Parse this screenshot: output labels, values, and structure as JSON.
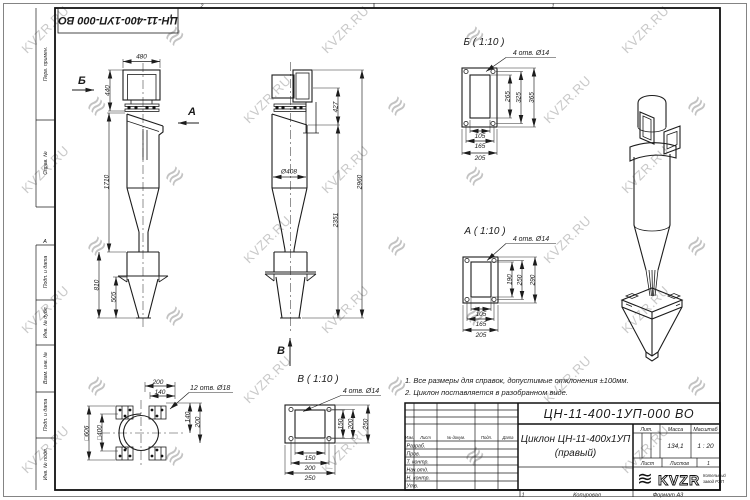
{
  "sheet": {
    "zone_top_left": "2",
    "zone_top_right": "1",
    "zone_left": "А",
    "stamp_top": "ЦН-11-400-1УП-000 ВО"
  },
  "margin_labels": {
    "perv": "Перв. примен.",
    "sprav": "Справ. №",
    "podp1": "Подп. и дата",
    "inv_dubl": "Инв. № дубл.",
    "vzam": "Взам. инв. №",
    "podp2": "Подп. и дата",
    "inv_podl": "Инв. № подл."
  },
  "views": {
    "side": {
      "arrow_b": "Б",
      "arrow_a": "А",
      "dim_480": "480",
      "dim_440": "440",
      "dim_1710": "1710",
      "dim_810": "810",
      "dim_505": "505"
    },
    "front": {
      "dim_427": "427",
      "dim_2960": "2960",
      "dim_2351": "2351",
      "dim_d408": "Ø408",
      "arrow_v": "В"
    },
    "detail_b": {
      "title": "Б ( 1:10 )",
      "holes": "4 отв. Ø14",
      "v": [
        "265",
        "325",
        "365"
      ],
      "h": [
        "105",
        "165",
        "205"
      ]
    },
    "detail_a": {
      "title": "А ( 1:10 )",
      "holes": "4 отв. Ø14",
      "v": [
        "190",
        "250",
        "290"
      ],
      "h": [
        "105",
        "165",
        "205"
      ]
    },
    "detail_v": {
      "title": "В ( 1:10 )",
      "holes": "4 отв. Ø14",
      "v": [
        "150",
        "200",
        "250"
      ],
      "h": [
        "150",
        "200",
        "250"
      ]
    },
    "plan": {
      "holes": "12 отв. Ø18",
      "top": [
        "200",
        "140"
      ],
      "right": [
        "140",
        "200"
      ],
      "left": [
        "□606",
        "□400"
      ]
    }
  },
  "notes": {
    "line1": "1. Все размеры для справок, допустимые отклонения ±100мм.",
    "line2": "2. Циклон поставляется в разобранном виде."
  },
  "title_block": {
    "doc_number": "ЦН-11-400-1УП-000 ВО",
    "name_line1": "Циклон ЦН-11-400х1УП",
    "name_line2": "(правый)",
    "cols": {
      "izm": "Изм.",
      "list": "Лист",
      "docum": "№ докум.",
      "podp": "Подп.",
      "data": "Дата"
    },
    "rows": [
      "Разраб.",
      "Пров.",
      "Т. контр.",
      "Нач.отд.",
      "Н. контр.",
      "Утв."
    ],
    "lit_label": "Лит.",
    "massa_label": "Масса",
    "masshtab_label": "Масштаб",
    "massa_value": "134,1",
    "masshtab_value": "1 : 20",
    "list_label": "Лист",
    "listov_label": "Листов",
    "listov_value": "1",
    "logo_text": "KVZR",
    "logo_mark": "≋",
    "logo_sub1": "Котельный",
    "logo_sub2": "завод РЭП"
  },
  "footer": {
    "sheet_num": "1",
    "kopiroval": "Копировал",
    "format": "Формат А3"
  },
  "watermark": {
    "text": "KVZR.RU",
    "logo": "≋"
  }
}
